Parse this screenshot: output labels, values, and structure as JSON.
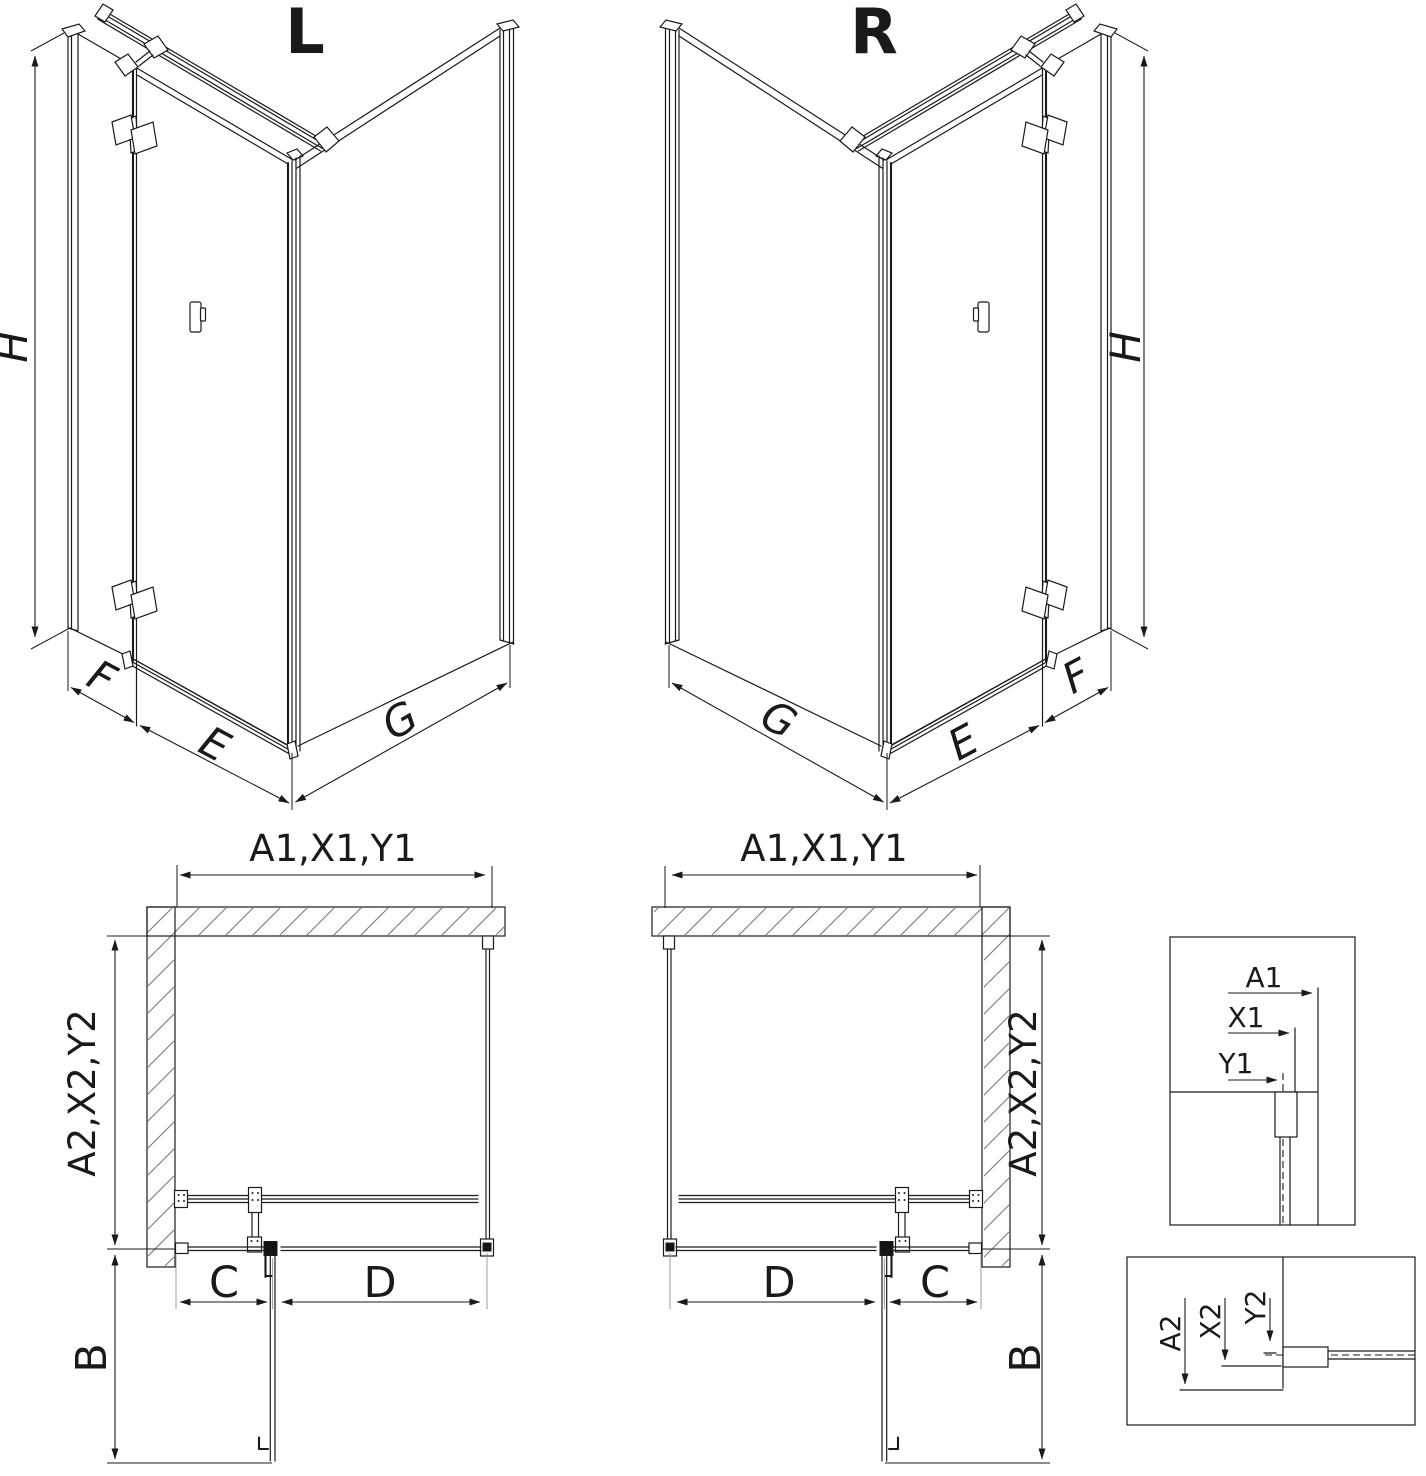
{
  "colors": {
    "line": "#1a1a1a",
    "gray_extension": "#9b9b9b",
    "hatch": "#787878",
    "background": "#ffffff"
  },
  "labels": {
    "left_iso": {
      "title": "L",
      "height": "H",
      "fixed_side": "F",
      "door_width": "E",
      "return_width": "G"
    },
    "right_iso": {
      "title": "R",
      "height": "H",
      "fixed_side": "F",
      "door_width": "E",
      "return_width": "G"
    },
    "left_plan": {
      "width_dim": "A1,X1,Y1",
      "depth_dim": "A2,X2,Y2",
      "door_swing": "B",
      "c_dim": "C",
      "d_dim": "D"
    },
    "right_plan": {
      "width_dim": "A1,X1,Y1",
      "depth_dim": "A2,X2,Y2",
      "door_swing": "B",
      "c_dim": "C",
      "d_dim": "D"
    },
    "detail_width": {
      "a1": "A1",
      "x1": "X1",
      "y1": "Y1"
    },
    "detail_depth": {
      "a2": "A2",
      "x2": "X2",
      "y2": "Y2"
    }
  }
}
